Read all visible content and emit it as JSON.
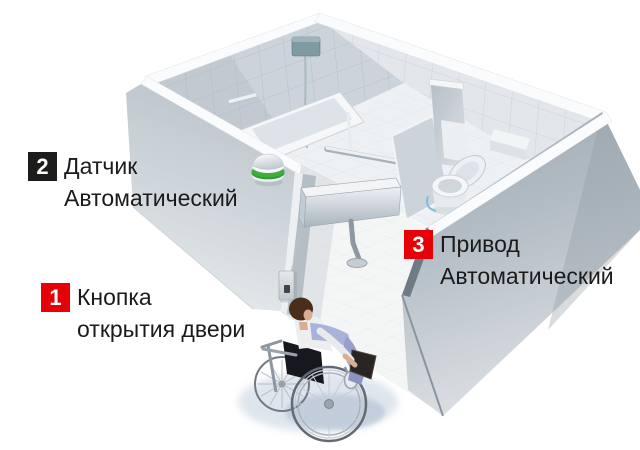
{
  "callouts": [
    {
      "number": "1",
      "lines": [
        "Кнопка",
        "открытия двери"
      ],
      "square_color": "#e60008"
    },
    {
      "number": "2",
      "lines": [
        "Датчик",
        "Автоматический"
      ],
      "square_color": "#1d1d1b"
    },
    {
      "number": "3",
      "lines": [
        "Привод",
        "Автоматический"
      ],
      "square_color": "#e60008"
    }
  ],
  "scene": {
    "elements": [
      "motion-sensor",
      "door-open-button",
      "automatic-door-actuator",
      "open-door-panel",
      "bathtub",
      "shower-unit",
      "grab-rail",
      "toilet-with-backrest",
      "cistern-shelf",
      "tiled-walls",
      "tiled-floor",
      "wheelchair-user"
    ],
    "colors": {
      "accent_red": "#e60008",
      "badge_black": "#1d1d1b",
      "sensor_green": "#3fae3a",
      "wall_gray": "#c3ccd3",
      "tile_gray": "#d2d9df",
      "shower_teal": "#7f9aa0",
      "pants_periwinkle": "#a9b2d8",
      "shadow_blue": "#c9d4e2"
    }
  }
}
